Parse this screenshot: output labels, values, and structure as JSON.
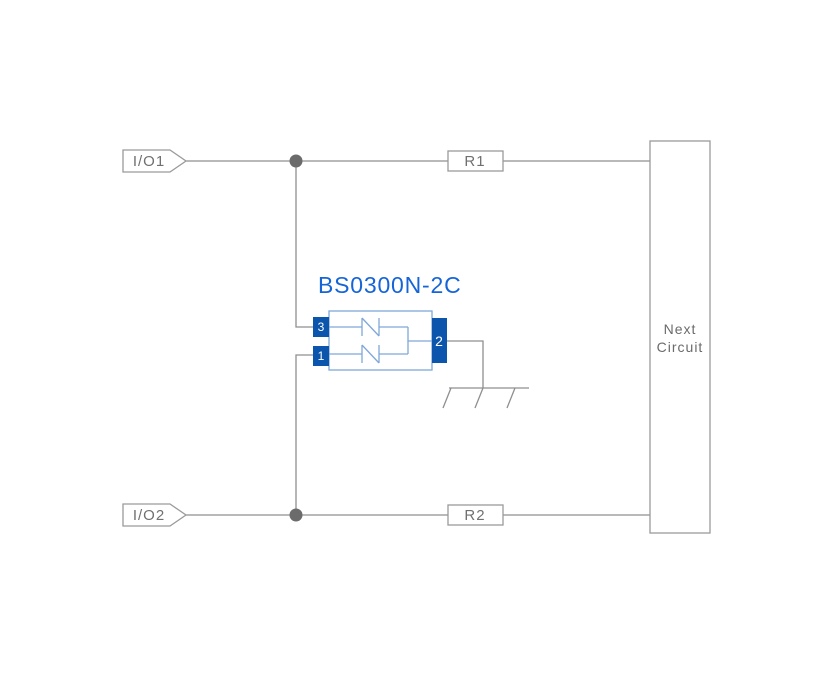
{
  "component": {
    "name": "BS0300N-2C",
    "pins": {
      "pin1": "1",
      "pin2": "2",
      "pin3": "3"
    }
  },
  "labels": {
    "io1": "I/O1",
    "io2": "I/O2",
    "r1": "R1",
    "r2": "R2"
  },
  "next_circuit": {
    "line1": "Next",
    "line2": "Circuit"
  },
  "icons": {
    "ground": "ground-symbol",
    "junction": "junction-dot",
    "io_flag": "net-flag"
  },
  "colors": {
    "background": "#ffffff",
    "wire_gray": "#8f8f8f",
    "outline_gray": "#9a9a9a",
    "label_text": "#707070",
    "next_text": "#6b6b6b",
    "junction_dot": "#6b6b6b",
    "component_blue": "#0b55ac",
    "title_blue": "#1565d8",
    "component_outline": "#7fa7d9",
    "pin_text": "#ffffff"
  }
}
